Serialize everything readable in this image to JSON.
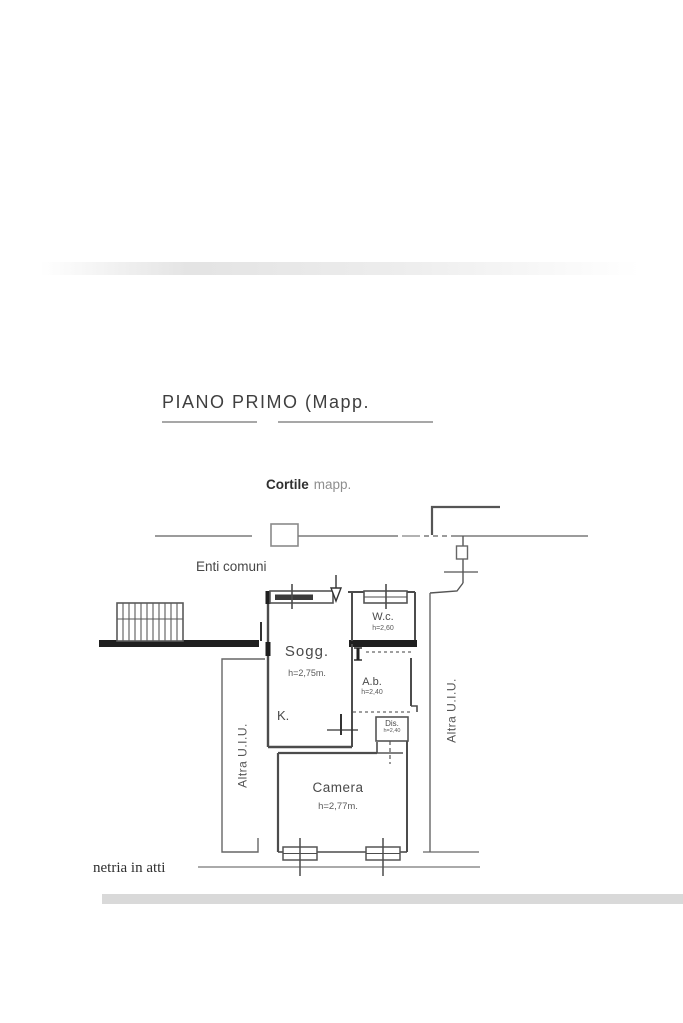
{
  "page": {
    "title": "PIANO  PRIMO (Mapp.",
    "footer_note": "netria in atti"
  },
  "plan": {
    "courtyard_label": "Cortile",
    "courtyard_label_suffix": "mapp.",
    "common_areas_label": "Enti comuni",
    "rooms": {
      "soggiorno": {
        "name": "Sogg.",
        "height": "h=2,75m."
      },
      "wc": {
        "name": "W.c.",
        "height": "h=2,60"
      },
      "antibagno": {
        "name": "A.b.",
        "height": "h=2,40"
      },
      "kitchen": {
        "name": "K."
      },
      "disimpegno": {
        "name": "Dis.",
        "height": "h=2,40"
      },
      "camera": {
        "name": "Camera",
        "height": "h=2,77m."
      }
    },
    "adjacent_unit_left": "Altra U.I.U.",
    "adjacent_unit_right": "Altra U.I.U."
  },
  "colors": {
    "line": "#5a5a5a",
    "wall_dark": "#1f1f1f",
    "band": "#d9d9d9",
    "text": "#3f3f3f"
  }
}
